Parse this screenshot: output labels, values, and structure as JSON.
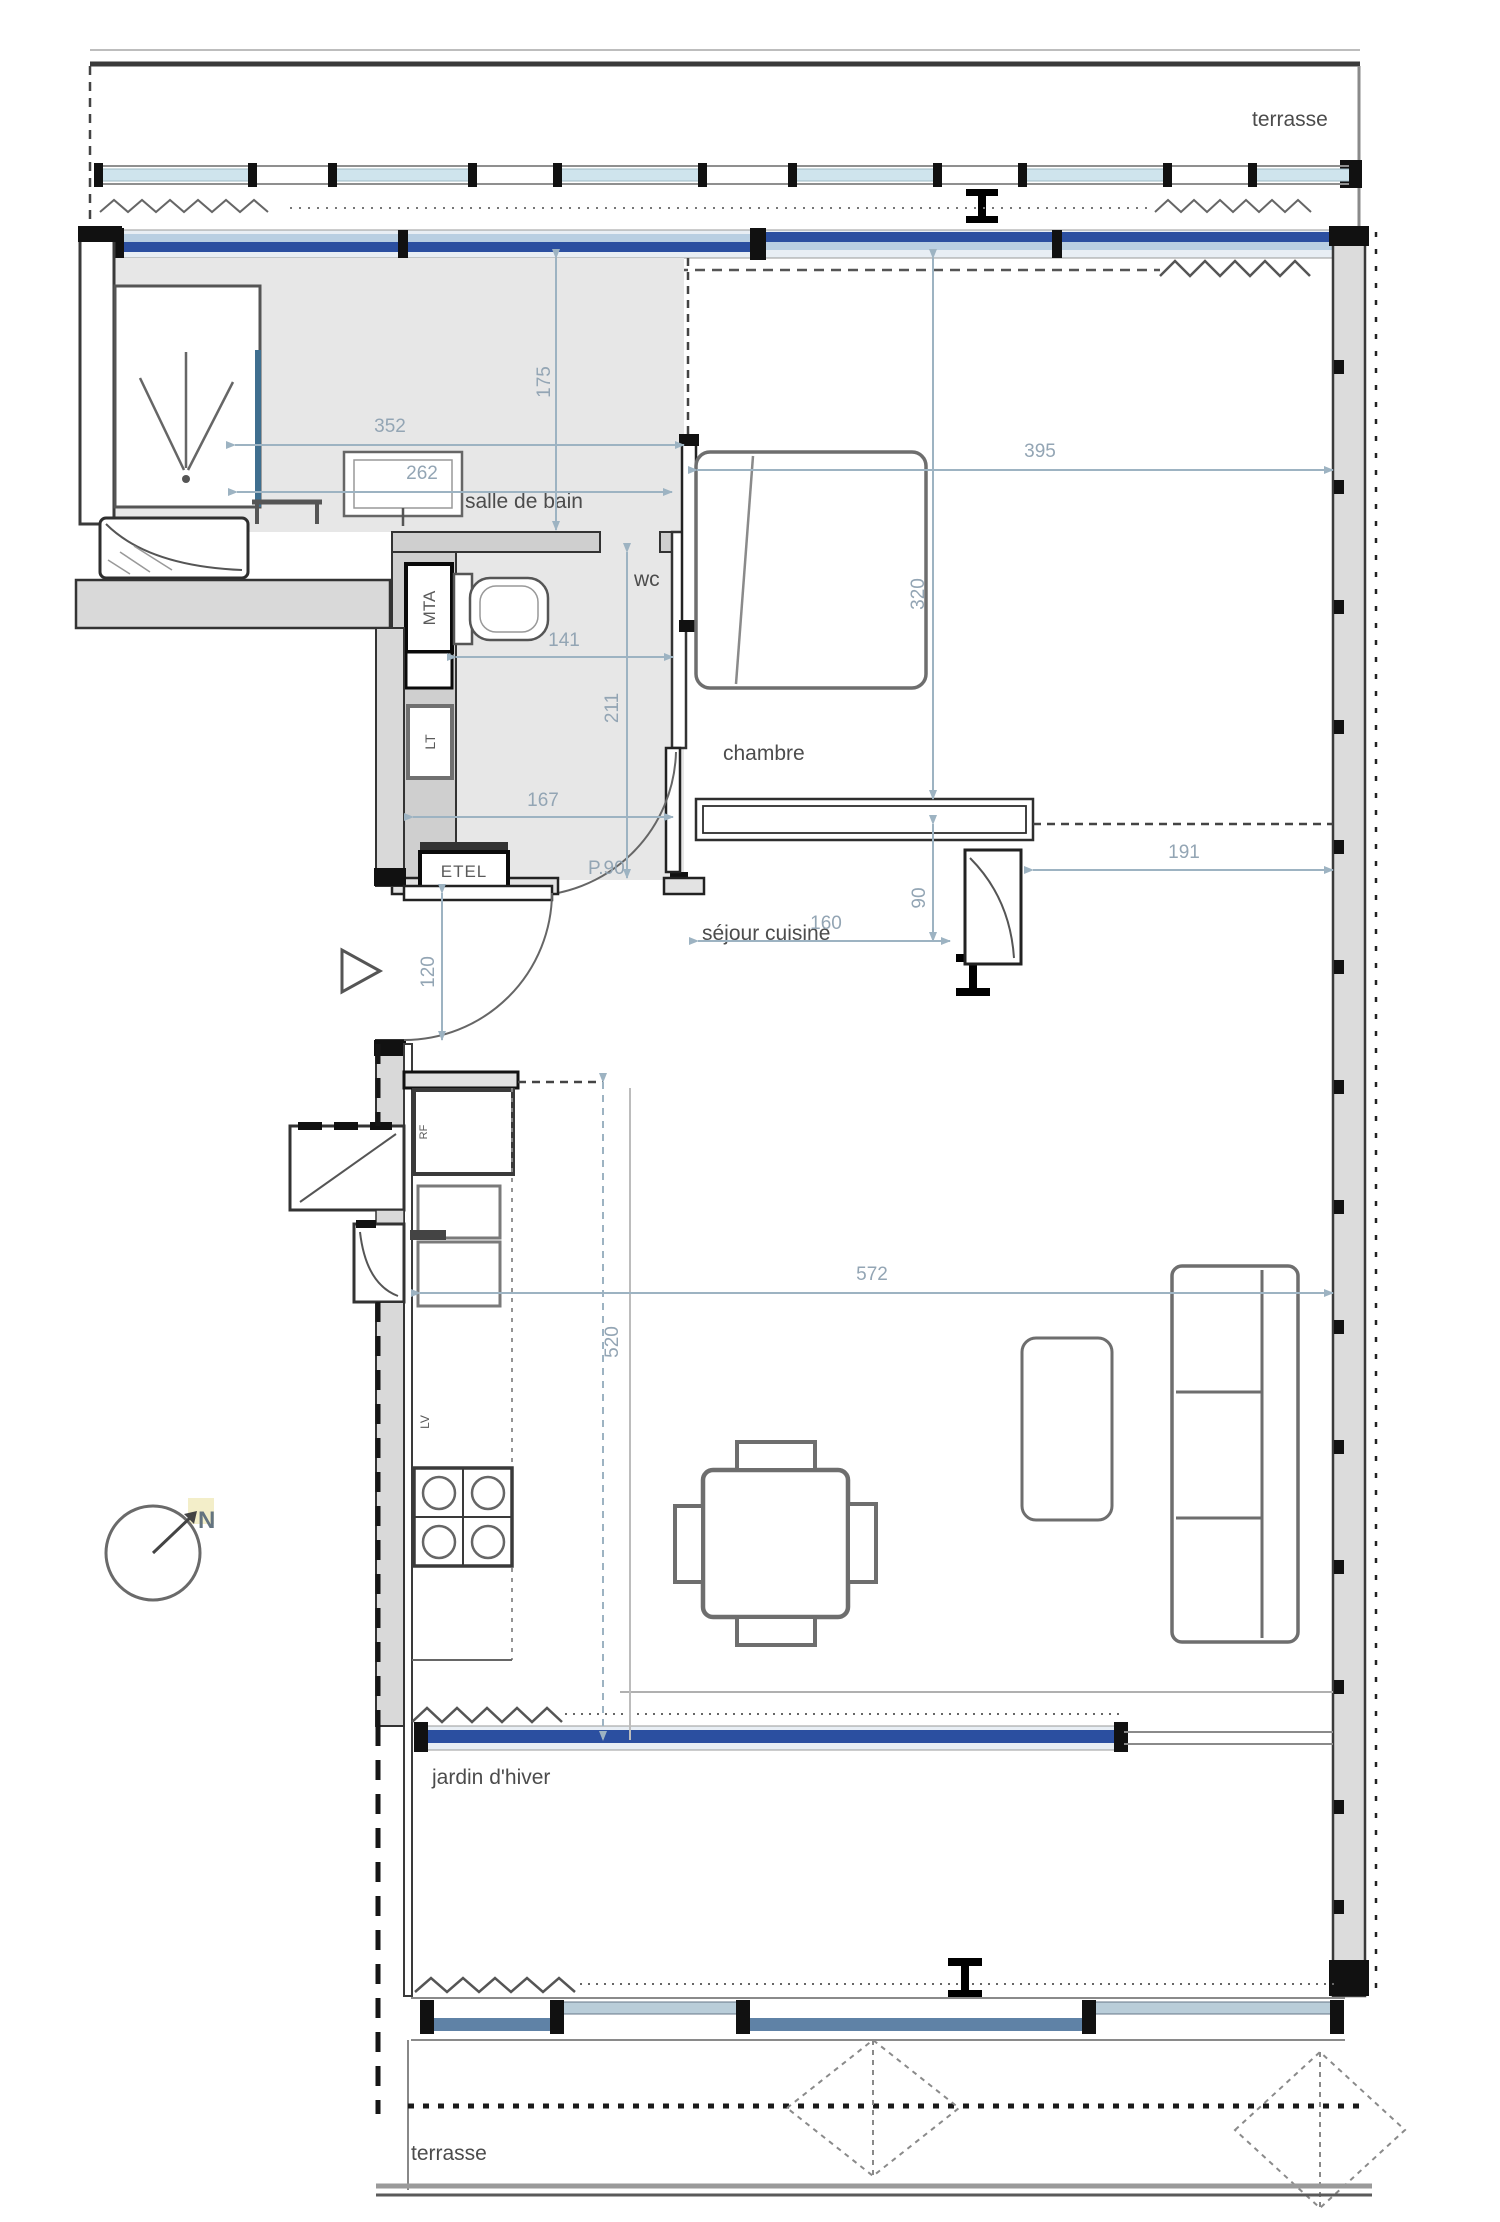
{
  "title": "apartment floor plan",
  "labels": {
    "terrace_top": "terrasse",
    "terrace_bottom": "terrasse",
    "bathroom": "salle de bain",
    "wc": "wc",
    "bedroom": "chambre",
    "living": "séjour cuisine",
    "winter_garden": "jardin d'hiver",
    "duct_shaft": "MTA",
    "duct_shaft2": "LT",
    "electrical_panel": "ETEL",
    "door_ref": "P.90",
    "fridge": "RF",
    "dishwasher": "LV",
    "north": "N"
  },
  "dimensions": {
    "bathroom_width": "352",
    "vanity_width": "262",
    "bathroom_depth": "175",
    "wc_width": "141",
    "wc_depth": "211",
    "hall_width": "167",
    "entry_width": "120",
    "bedroom_width": "395",
    "bedroom_depth": "320",
    "wardrobe_width": "160",
    "closet_depth": "90",
    "bedroom_right": "191",
    "living_width": "572",
    "living_depth": "520"
  },
  "colors": {
    "glazing_dark_blue": "#2b4fa0",
    "glazing_light_blue": "#b9cfe2",
    "railing_glass": "#cfe4ed",
    "south_glazing": "#5f82a6",
    "floor_gray": "#e7e7e7",
    "wall_gray": "#d9d9d9",
    "dimension_blue": "#9db3c2"
  }
}
